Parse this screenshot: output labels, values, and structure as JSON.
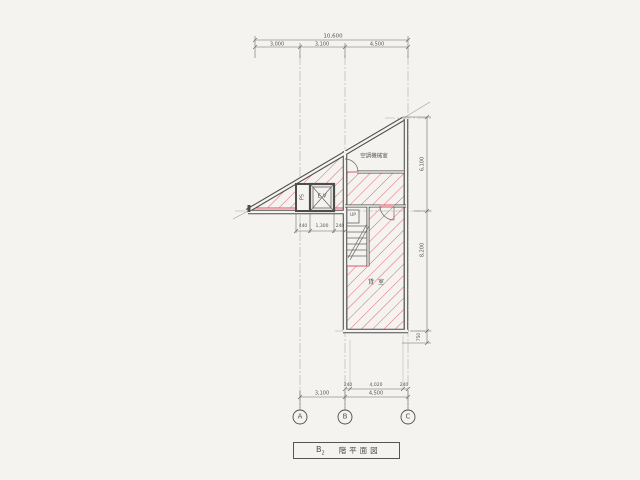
{
  "colors": {
    "paper": "#f4f3ef",
    "line": "#4d4d4d",
    "dim": "#6a6a6a",
    "centerline": "#9a9a9a",
    "hatch": "#e0556a",
    "red": "#cc3a50"
  },
  "title_block": {
    "floor_letter": "B",
    "floor_number": "2",
    "drawing_title": "階平面図"
  },
  "grid": {
    "columns": [
      "A",
      "B",
      "C"
    ]
  },
  "rooms": {
    "machine_room": "空調機械室",
    "main_room": "貸室"
  },
  "labels": {
    "pipe_shaft": "PS",
    "elevator": "E.V",
    "stair_up": "UP"
  },
  "dimensions": {
    "top": {
      "total": "10,600",
      "segments": [
        "3,000",
        "3,100",
        "4,500"
      ]
    },
    "right": {
      "segments": [
        "6,100",
        "8,200",
        "750"
      ]
    },
    "bottom_inner": {
      "segments": [
        "240",
        "4,020",
        "240"
      ]
    },
    "bottom_outer": {
      "segments": [
        "3,100",
        "4,500"
      ]
    },
    "shaft_row": {
      "segments": [
        "440",
        "1,300",
        "240"
      ]
    }
  }
}
